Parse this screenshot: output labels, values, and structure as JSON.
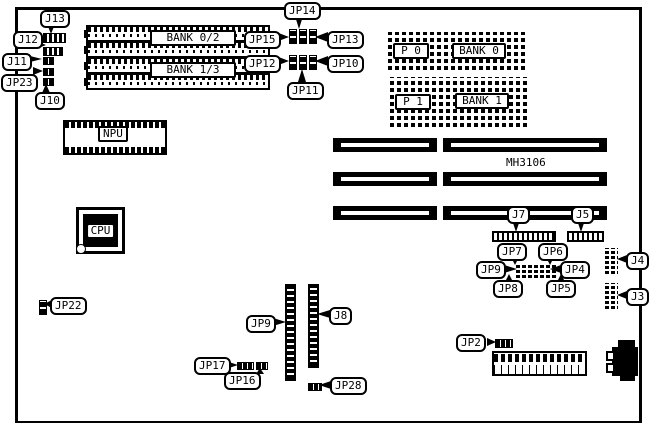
{
  "diagram": {
    "type": "motherboard-layout",
    "model": "MH3106",
    "fg_color": "#000000",
    "bg_color": "#ffffff"
  },
  "memory": {
    "simm_bank_a": "BANK 0/2",
    "simm_bank_b": "BANK 1/3",
    "dram_p0": "P 0",
    "dram_bank0": "BANK 0",
    "dram_p1": "P 1",
    "dram_bank1": "BANK 1"
  },
  "chips": {
    "npu": "NPU",
    "cpu": "CPU"
  },
  "connectors": {
    "j13": "J13",
    "j12": "J12",
    "j11": "J11",
    "j10": "J10",
    "j8": "J8",
    "j7": "J7",
    "j5": "J5",
    "j4": "J4",
    "j3": "J3"
  },
  "jumpers": {
    "jp23": "JP23",
    "jp14": "JP14",
    "jp15": "JP15",
    "jp13": "JP13",
    "jp12": "JP12",
    "jp10": "JP10",
    "jp11": "JP11",
    "jp7": "JP7",
    "jp6": "JP6",
    "jp9_block": "JP9",
    "jp4": "JP4",
    "jp8": "JP8",
    "jp5": "JP5",
    "jp9_header": "JP9",
    "jp22": "JP22",
    "jp17": "JP17",
    "jp16": "JP16",
    "jp28": "JP28",
    "jp2": "JP2"
  }
}
